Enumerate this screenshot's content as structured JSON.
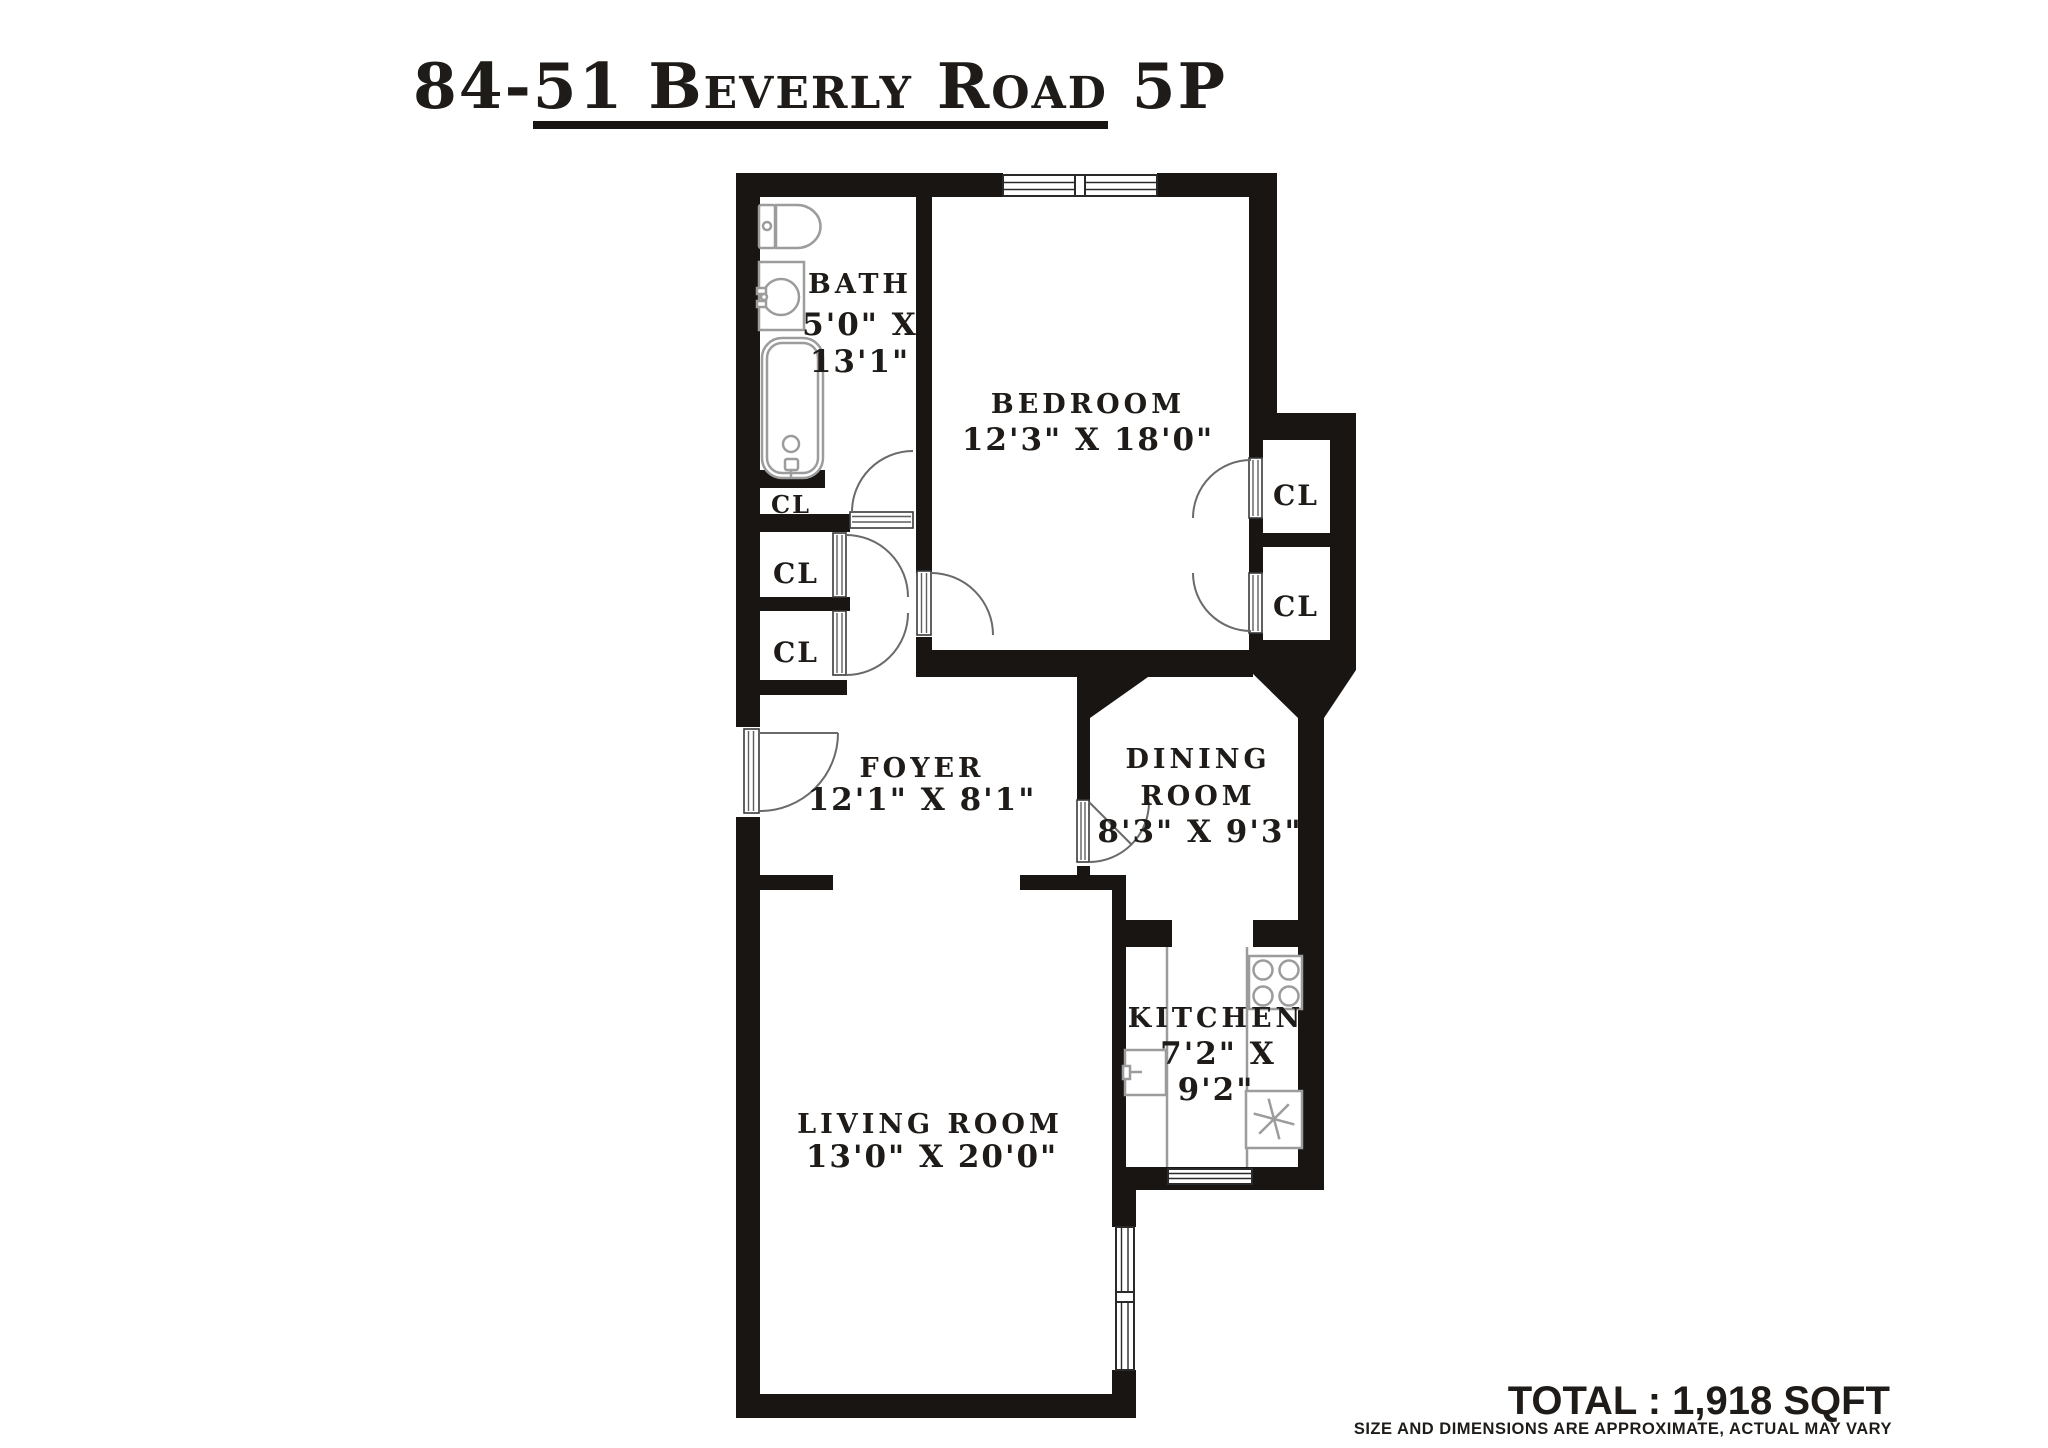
{
  "title": "84-51 Beverly Road 5P",
  "plan": {
    "rooms": {
      "bath": {
        "name": "BATH",
        "dims1": "5'0\" X",
        "dims2": "13'1\""
      },
      "bedroom": {
        "name": "BEDROOM",
        "dims": "12'3\" X 18'0\""
      },
      "foyer": {
        "name": "FOYER",
        "dims": "12'1\" X 8'1\""
      },
      "dining": {
        "name1": "DINING",
        "name2": "ROOM",
        "dims": "8'3\" X 9'3\""
      },
      "kitchen": {
        "name": "KITCHEN",
        "dims1": "7'2\" X",
        "dims2": "9'2\""
      },
      "living": {
        "name": "LIVING ROOM",
        "dims": "13'0\" X 20'0\""
      },
      "closet_label": "CL"
    }
  },
  "footer": {
    "total": "TOTAL : 1,918 SQFT",
    "disclaimer": "SIZE AND DIMENSIONS ARE APPROXIMATE, ACTUAL MAY VARY"
  },
  "colors": {
    "background": "#ffffff",
    "wall": "#181512",
    "fixture": "#9c9c9c",
    "text": "#1e1b18"
  }
}
